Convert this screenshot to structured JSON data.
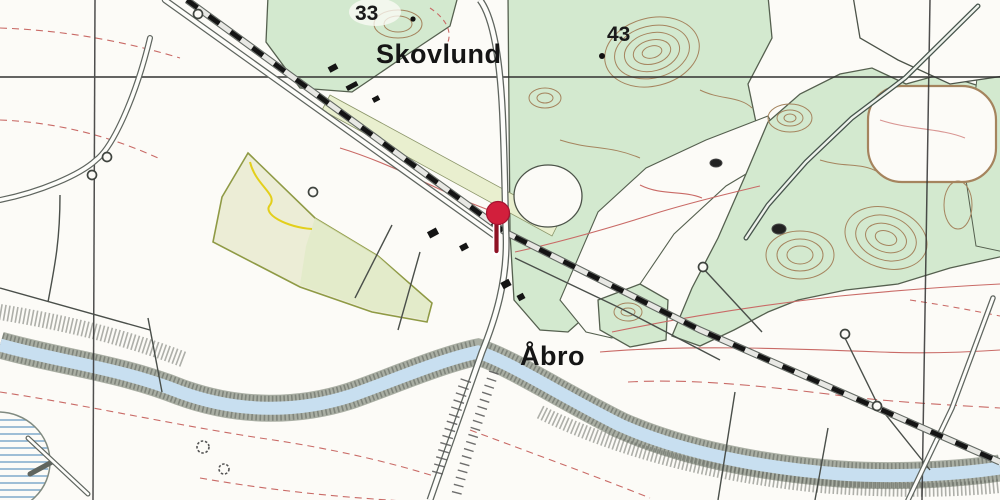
{
  "map": {
    "type": "topographic-map",
    "region_language": "Danish",
    "place_labels": [
      {
        "id": "skovlund",
        "text": "Skovlund"
      },
      {
        "id": "aabro",
        "text": "Åbro"
      }
    ],
    "elevation_points": [
      {
        "value": "33"
      },
      {
        "value": "43"
      }
    ],
    "marker": {
      "name": "location-pin",
      "head_color": "#d21f3c",
      "stem_color": "#8e1224"
    },
    "legend_colors": {
      "paper": "#fcfbf7",
      "forest_green": "#d3e9cf",
      "water_blue": "#c8dff0",
      "forest_contour_brown": "#a5845e",
      "field_contour_red": "#c96a66",
      "railway_black": "#141414",
      "cultivated_field_yellow": "#ecedd6",
      "grid_line": "#3a3a3a"
    }
  }
}
